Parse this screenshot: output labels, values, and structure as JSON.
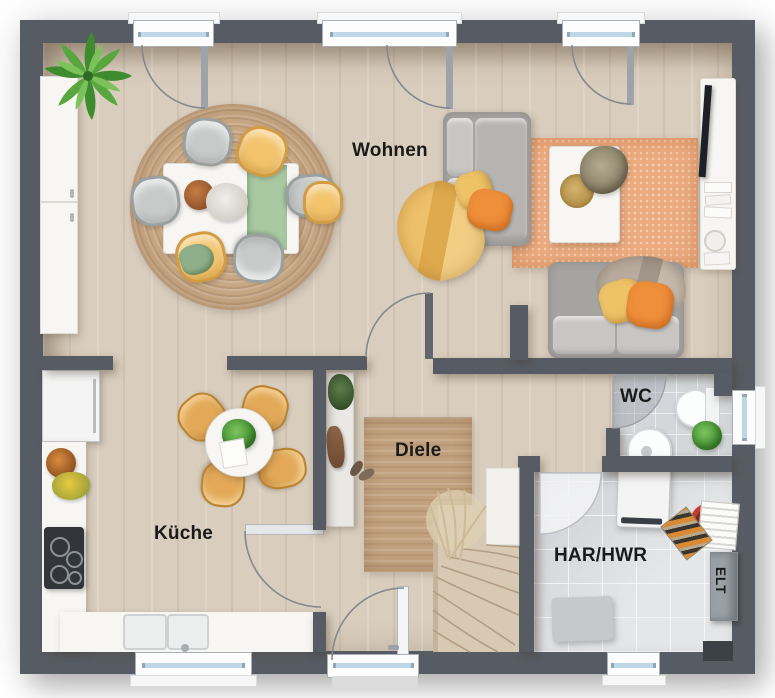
{
  "plan": {
    "type": "residential-ground-floor-plan",
    "style": "3d-top-down-rendering"
  },
  "rooms": {
    "living": {
      "label": "Wohnen"
    },
    "kitchen": {
      "label": "Küche"
    },
    "hallway": {
      "label": "Diele"
    },
    "wc": {
      "label": "WC"
    },
    "utility": {
      "label": "HAR/HWR"
    },
    "electrical": {
      "label": "ELT"
    }
  },
  "colors": {
    "wall": "#575c64",
    "wood_floor": "#d9cdbd",
    "tile_floor": "#d6d8da",
    "jute_rug": "#c7a683",
    "orange_rug": "#ecab7f",
    "accent_orange": "#ef8f3a",
    "accent_yellow": "#eec267",
    "accent_green": "#58a744",
    "window_glass": "#bdd7e7"
  }
}
